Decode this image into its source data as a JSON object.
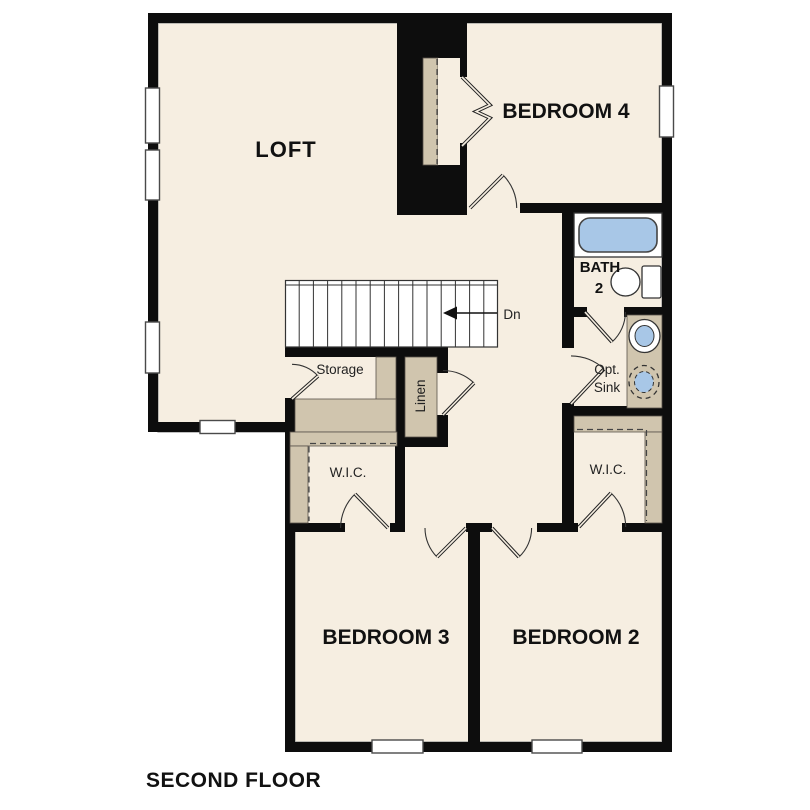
{
  "floor_plan": {
    "title": "SECOND FLOOR",
    "labels": {
      "loft": "LOFT",
      "bedroom4": "BEDROOM 4",
      "bedroom3": "BEDROOM 3",
      "bedroom2": "BEDROOM 2",
      "bath": "BATH",
      "bath_number": "2",
      "storage": "Storage",
      "linen": "Linen",
      "wic_left": "W.I.C.",
      "wic_right": "W.I.C.",
      "opt_sink_line1": "Opt.",
      "opt_sink_line2": "Sink",
      "stair_direction": "Dn"
    },
    "colors": {
      "background": "#ffffff",
      "floor": "#f6eee1",
      "casework": "#d0c5ae",
      "wall": "#0d0d0d",
      "fixture_blue": "#a8c7e7"
    }
  }
}
